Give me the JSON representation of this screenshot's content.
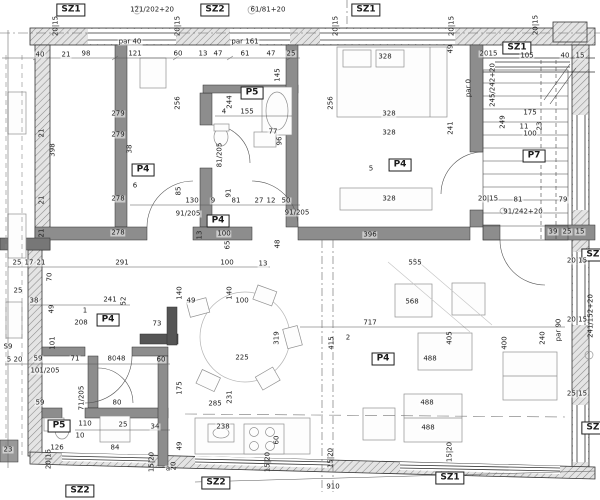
{
  "drawing_colors": {
    "line": "#2a2a2a",
    "wall_fill": "#8d8d8d",
    "hatch": "#8a8a8a",
    "background": "#ffffff"
  },
  "labels": [
    {
      "t": "SZ1",
      "x": 71,
      "y": 10,
      "b": 1
    },
    {
      "t": "SZ2",
      "x": 215,
      "y": 10,
      "b": 1
    },
    {
      "t": "SZ1",
      "x": 366,
      "y": 10,
      "b": 1
    },
    {
      "t": "SZ1",
      "x": 517,
      "y": 48,
      "b": 1
    },
    {
      "t": "SZ1",
      "x": 596,
      "y": 255,
      "b": 1
    },
    {
      "t": "SZ1",
      "x": 596,
      "y": 428,
      "b": 1
    },
    {
      "t": "SZ2",
      "x": 80,
      "y": 491,
      "b": 1
    },
    {
      "t": "SZ2",
      "x": 216,
      "y": 483,
      "b": 1
    },
    {
      "t": "SZ1",
      "x": 450,
      "y": 478,
      "b": 1
    },
    {
      "t": "P5",
      "x": 252,
      "y": 93,
      "b": 1
    },
    {
      "t": "P4",
      "x": 143,
      "y": 170,
      "b": 1
    },
    {
      "t": "P4",
      "x": 218,
      "y": 221,
      "b": 1
    },
    {
      "t": "P4",
      "x": 400,
      "y": 165,
      "b": 1
    },
    {
      "t": "P7",
      "x": 534,
      "y": 156,
      "b": 1
    },
    {
      "t": "P4",
      "x": 108,
      "y": 320,
      "b": 1
    },
    {
      "t": "P4",
      "x": 383,
      "y": 359,
      "b": 1
    },
    {
      "t": "P5",
      "x": 59,
      "y": 426,
      "b": 1
    },
    {
      "t": "121/202+20",
      "x": 152,
      "y": 10
    },
    {
      "t": "61/81+20",
      "x": 268,
      "y": 10
    },
    {
      "t": "245/242+20",
      "x": 493,
      "y": 85,
      "r": 1
    },
    {
      "t": "241/152+20",
      "x": 591,
      "y": 316,
      "r": 1
    },
    {
      "t": "91/242+20",
      "x": 523,
      "y": 212
    },
    {
      "t": "par 40",
      "x": 130,
      "y": 42
    },
    {
      "t": "par 161",
      "x": 245,
      "y": 42
    },
    {
      "t": "par 0",
      "x": 469,
      "y": 88,
      "r": 1
    },
    {
      "t": "par 90",
      "x": 559,
      "y": 330,
      "r": 1
    },
    {
      "t": "91/205",
      "x": 188,
      "y": 214
    },
    {
      "t": "91/205",
      "x": 297,
      "y": 213
    },
    {
      "t": "81/205",
      "x": 220,
      "y": 155,
      "r": 1
    },
    {
      "t": "71/205",
      "x": 82,
      "y": 398,
      "r": 1
    },
    {
      "t": "101/205",
      "x": 45,
      "y": 371
    },
    {
      "t": "40",
      "x": 40,
      "y": 55
    },
    {
      "t": "21",
      "x": 66,
      "y": 55
    },
    {
      "t": "98",
      "x": 86,
      "y": 54
    },
    {
      "t": "121",
      "x": 135,
      "y": 54
    },
    {
      "t": "60",
      "x": 178,
      "y": 54
    },
    {
      "t": "13",
      "x": 203,
      "y": 54
    },
    {
      "t": "47",
      "x": 218,
      "y": 54
    },
    {
      "t": "61",
      "x": 245,
      "y": 54
    },
    {
      "t": "47",
      "x": 271,
      "y": 54
    },
    {
      "t": "25",
      "x": 291,
      "y": 54
    },
    {
      "t": "20",
      "x": 484,
      "y": 54
    },
    {
      "t": "15",
      "x": 493,
      "y": 54
    },
    {
      "t": "105",
      "x": 527,
      "y": 56
    },
    {
      "t": "40",
      "x": 565,
      "y": 56
    },
    {
      "t": "15",
      "x": 580,
      "y": 56
    },
    {
      "t": "20|15",
      "x": 56,
      "y": 26,
      "r": 1
    },
    {
      "t": "20|15",
      "x": 178,
      "y": 26,
      "r": 1
    },
    {
      "t": "20|15",
      "x": 336,
      "y": 26,
      "r": 1
    },
    {
      "t": "20|15",
      "x": 452,
      "y": 26,
      "r": 1
    },
    {
      "t": "20|15",
      "x": 536,
      "y": 25,
      "r": 1
    },
    {
      "t": "328",
      "x": 385,
      "y": 57
    },
    {
      "t": "49",
      "x": 451,
      "y": 49,
      "r": 1
    },
    {
      "t": "256",
      "x": 331,
      "y": 103,
      "r": 1
    },
    {
      "t": "328",
      "x": 389,
      "y": 114
    },
    {
      "t": "328",
      "x": 389,
      "y": 133
    },
    {
      "t": "241",
      "x": 451,
      "y": 128,
      "r": 1
    },
    {
      "t": "5",
      "x": 371,
      "y": 169
    },
    {
      "t": "328",
      "x": 389,
      "y": 199
    },
    {
      "t": "396",
      "x": 370,
      "y": 235
    },
    {
      "t": "555",
      "x": 415,
      "y": 263
    },
    {
      "t": "256",
      "x": 178,
      "y": 103,
      "r": 1
    },
    {
      "t": "244",
      "x": 230,
      "y": 102,
      "r": 1
    },
    {
      "t": "145",
      "x": 278,
      "y": 75,
      "r": 1
    },
    {
      "t": "4",
      "x": 224,
      "y": 112
    },
    {
      "t": "155",
      "x": 247,
      "y": 112
    },
    {
      "t": "77",
      "x": 273,
      "y": 132
    },
    {
      "t": "96",
      "x": 280,
      "y": 141,
      "r": 1
    },
    {
      "t": "279",
      "x": 118,
      "y": 114
    },
    {
      "t": "279",
      "x": 118,
      "y": 135
    },
    {
      "t": "398",
      "x": 53,
      "y": 150,
      "r": 1
    },
    {
      "t": "38",
      "x": 130,
      "y": 149,
      "r": 1
    },
    {
      "t": "6",
      "x": 135,
      "y": 186
    },
    {
      "t": "278",
      "x": 118,
      "y": 199
    },
    {
      "t": "278",
      "x": 118,
      "y": 233
    },
    {
      "t": "291",
      "x": 122,
      "y": 263
    },
    {
      "t": "70",
      "x": 50,
      "y": 277,
      "r": 1
    },
    {
      "t": "21",
      "x": 42,
      "y": 133,
      "r": 1
    },
    {
      "t": "21",
      "x": 42,
      "y": 200,
      "r": 1
    },
    {
      "t": "21",
      "x": 42,
      "y": 233,
      "r": 1
    },
    {
      "t": "85",
      "x": 179,
      "y": 191,
      "r": 1
    },
    {
      "t": "130",
      "x": 192,
      "y": 201
    },
    {
      "t": "9",
      "x": 213,
      "y": 201
    },
    {
      "t": "91",
      "x": 229,
      "y": 193,
      "r": 1
    },
    {
      "t": "81",
      "x": 236,
      "y": 201
    },
    {
      "t": "27",
      "x": 259,
      "y": 201
    },
    {
      "t": "12",
      "x": 271,
      "y": 201
    },
    {
      "t": "50",
      "x": 286,
      "y": 201
    },
    {
      "t": "100",
      "x": 224,
      "y": 234
    },
    {
      "t": "13",
      "x": 200,
      "y": 235,
      "r": 1
    },
    {
      "t": "65",
      "x": 228,
      "y": 245,
      "r": 1
    },
    {
      "t": "48",
      "x": 278,
      "y": 244,
      "r": 1
    },
    {
      "t": "100",
      "x": 227,
      "y": 263
    },
    {
      "t": "13",
      "x": 263,
      "y": 264
    },
    {
      "t": "25",
      "x": 17,
      "y": 263
    },
    {
      "t": "17",
      "x": 29,
      "y": 263
    },
    {
      "t": "21",
      "x": 41,
      "y": 263
    },
    {
      "t": "25",
      "x": 18,
      "y": 291
    },
    {
      "t": "38",
      "x": 34,
      "y": 301
    },
    {
      "t": "101",
      "x": 53,
      "y": 343,
      "r": 1
    },
    {
      "t": "S9",
      "x": 8,
      "y": 347
    },
    {
      "t": "5",
      "x": 9,
      "y": 360
    },
    {
      "t": "20",
      "x": 18,
      "y": 360
    },
    {
      "t": "241",
      "x": 110,
      "y": 300
    },
    {
      "t": "52",
      "x": 124,
      "y": 301,
      "r": 1
    },
    {
      "t": "49",
      "x": 52,
      "y": 309,
      "r": 1
    },
    {
      "t": "1",
      "x": 85,
      "y": 311
    },
    {
      "t": "208",
      "x": 81,
      "y": 323
    },
    {
      "t": "73",
      "x": 157,
      "y": 324
    },
    {
      "t": "140",
      "x": 180,
      "y": 293,
      "r": 1
    },
    {
      "t": "49",
      "x": 191,
      "y": 301
    },
    {
      "t": "140",
      "x": 230,
      "y": 293,
      "r": 1
    },
    {
      "t": "100",
      "x": 242,
      "y": 301
    },
    {
      "t": "319",
      "x": 277,
      "y": 338,
      "r": 1
    },
    {
      "t": "225",
      "x": 242,
      "y": 358
    },
    {
      "t": "415",
      "x": 332,
      "y": 343,
      "r": 1
    },
    {
      "t": "59",
      "x": 38,
      "y": 359
    },
    {
      "t": "71",
      "x": 75,
      "y": 359
    },
    {
      "t": "80",
      "x": 112,
      "y": 359
    },
    {
      "t": "48",
      "x": 121,
      "y": 359
    },
    {
      "t": "60",
      "x": 161,
      "y": 360
    },
    {
      "t": "59",
      "x": 40,
      "y": 403
    },
    {
      "t": "80",
      "x": 117,
      "y": 403
    },
    {
      "t": "110",
      "x": 85,
      "y": 424
    },
    {
      "t": "25",
      "x": 123,
      "y": 425
    },
    {
      "t": "34",
      "x": 155,
      "y": 427
    },
    {
      "t": "10",
      "x": 80,
      "y": 436
    },
    {
      "t": "126",
      "x": 57,
      "y": 448
    },
    {
      "t": "84",
      "x": 115,
      "y": 448
    },
    {
      "t": "175",
      "x": 180,
      "y": 388,
      "r": 1
    },
    {
      "t": "49",
      "x": 180,
      "y": 446,
      "r": 1
    },
    {
      "t": "20",
      "x": 174,
      "y": 466,
      "r": 1
    },
    {
      "t": "23",
      "x": 8,
      "y": 450
    },
    {
      "t": "20|15",
      "x": 49,
      "y": 459,
      "r": 1
    },
    {
      "t": "15|20",
      "x": 152,
      "y": 462,
      "r": 1
    },
    {
      "t": "2",
      "x": 348,
      "y": 338
    },
    {
      "t": "717",
      "x": 370,
      "y": 323
    },
    {
      "t": "568",
      "x": 412,
      "y": 302
    },
    {
      "t": "405",
      "x": 450,
      "y": 338,
      "r": 1
    },
    {
      "t": "488",
      "x": 430,
      "y": 359
    },
    {
      "t": "400",
      "x": 505,
      "y": 343,
      "r": 1
    },
    {
      "t": "240",
      "x": 543,
      "y": 338,
      "r": 1
    },
    {
      "t": "488",
      "x": 427,
      "y": 403
    },
    {
      "t": "488",
      "x": 428,
      "y": 428
    },
    {
      "t": "285",
      "x": 215,
      "y": 404
    },
    {
      "t": "231",
      "x": 230,
      "y": 397,
      "r": 1
    },
    {
      "t": "238",
      "x": 223,
      "y": 427
    },
    {
      "t": "60",
      "x": 277,
      "y": 440,
      "r": 1
    },
    {
      "t": "910",
      "x": 333,
      "y": 487
    },
    {
      "t": "a",
      "x": 168,
      "y": 469
    },
    {
      "t": "15|20",
      "x": 268,
      "y": 462,
      "r": 1
    },
    {
      "t": "15|20",
      "x": 331,
      "y": 458,
      "r": 1
    },
    {
      "t": "15|20",
      "x": 450,
      "y": 452,
      "r": 1
    },
    {
      "t": "175",
      "x": 530,
      "y": 113
    },
    {
      "t": "249",
      "x": 503,
      "y": 122,
      "r": 1
    },
    {
      "t": "11",
      "x": 524,
      "y": 127
    },
    {
      "t": "23",
      "x": 540,
      "y": 126,
      "r": 1
    },
    {
      "t": "100",
      "x": 530,
      "y": 134
    },
    {
      "t": "20|15",
      "x": 488,
      "y": 199
    },
    {
      "t": "81",
      "x": 518,
      "y": 200
    },
    {
      "t": "79",
      "x": 563,
      "y": 200
    },
    {
      "t": "39",
      "x": 553,
      "y": 232
    },
    {
      "t": "25",
      "x": 567,
      "y": 232
    },
    {
      "t": "15",
      "x": 580,
      "y": 232
    },
    {
      "t": "20|15",
      "x": 577,
      "y": 261
    },
    {
      "t": "20|15",
      "x": 577,
      "y": 320
    },
    {
      "t": "25|15",
      "x": 577,
      "y": 394
    }
  ]
}
